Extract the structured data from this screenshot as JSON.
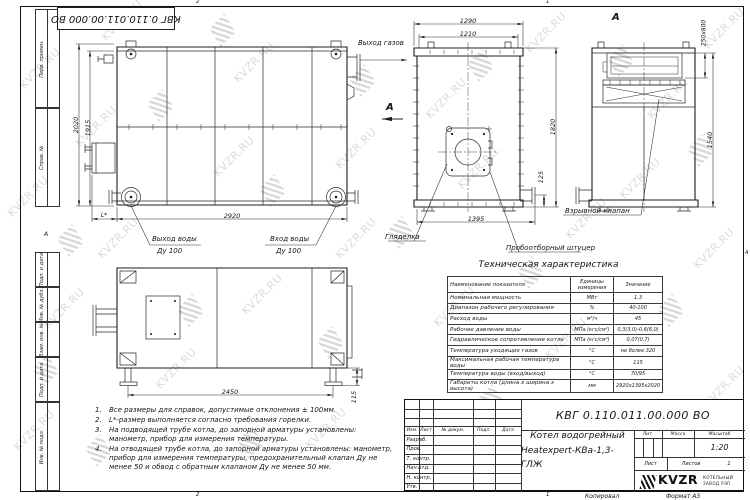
{
  "watermark": {
    "text": "KVZR.RU",
    "color": "#9aa2a9",
    "items": [
      {
        "x": 14,
        "y": 62,
        "t": "text"
      },
      {
        "x": 2,
        "y": 190,
        "t": "text"
      },
      {
        "x": 38,
        "y": 302,
        "t": "text"
      },
      {
        "x": 8,
        "y": 424,
        "t": "text"
      },
      {
        "x": 70,
        "y": 120,
        "t": "text"
      },
      {
        "x": 96,
        "y": 14,
        "t": "text"
      },
      {
        "x": 228,
        "y": 56,
        "t": "text"
      },
      {
        "x": 330,
        "y": 142,
        "t": "text"
      },
      {
        "x": 236,
        "y": 288,
        "t": "text"
      },
      {
        "x": 150,
        "y": 362,
        "t": "text"
      },
      {
        "x": 300,
        "y": 422,
        "t": "text"
      },
      {
        "x": 420,
        "y": 92,
        "t": "text"
      },
      {
        "x": 520,
        "y": 26,
        "t": "text"
      },
      {
        "x": 452,
        "y": 162,
        "t": "text"
      },
      {
        "x": 560,
        "y": 212,
        "t": "text"
      },
      {
        "x": 642,
        "y": 92,
        "t": "text"
      },
      {
        "x": 698,
        "y": 22,
        "t": "text"
      },
      {
        "x": 614,
        "y": 172,
        "t": "text"
      },
      {
        "x": 688,
        "y": 242,
        "t": "text"
      },
      {
        "x": 540,
        "y": 332,
        "t": "text"
      },
      {
        "x": 428,
        "y": 300,
        "t": "text"
      },
      {
        "x": 618,
        "y": 420,
        "t": "text"
      },
      {
        "x": 698,
        "y": 380,
        "t": "text"
      },
      {
        "x": 330,
        "y": 232,
        "t": "text"
      },
      {
        "x": 92,
        "y": 232,
        "t": "text"
      },
      {
        "x": 208,
        "y": 150,
        "t": "text"
      },
      {
        "x": 150,
        "y": 95,
        "t": "logo"
      },
      {
        "x": 60,
        "y": 230,
        "t": "logo"
      },
      {
        "x": 212,
        "y": 20,
        "t": "logo"
      },
      {
        "x": 352,
        "y": 70,
        "t": "logo"
      },
      {
        "x": 470,
        "y": 55,
        "t": "logo"
      },
      {
        "x": 610,
        "y": 50,
        "t": "logo"
      },
      {
        "x": 690,
        "y": 140,
        "t": "logo"
      },
      {
        "x": 262,
        "y": 180,
        "t": "logo"
      },
      {
        "x": 390,
        "y": 222,
        "t": "logo"
      },
      {
        "x": 180,
        "y": 300,
        "t": "logo"
      },
      {
        "x": 320,
        "y": 332,
        "t": "logo"
      },
      {
        "x": 35,
        "y": 360,
        "t": "logo"
      },
      {
        "x": 480,
        "y": 390,
        "t": "logo"
      },
      {
        "x": 560,
        "y": 432,
        "t": "logo"
      },
      {
        "x": 660,
        "y": 300,
        "t": "logo"
      },
      {
        "x": 703,
        "y": 450,
        "t": "logo"
      },
      {
        "x": 240,
        "y": 432,
        "t": "logo"
      },
      {
        "x": 520,
        "y": 262,
        "t": "logo"
      },
      {
        "x": 430,
        "y": 440,
        "t": "logo"
      },
      {
        "x": 88,
        "y": 440,
        "t": "logo"
      }
    ]
  },
  "frame": {
    "stamp_rotated": "КВГ 0.110.011.00.000 ВО",
    "strip": [
      "Перв. примен.",
      "Справ. №",
      "Подп. и дата",
      "Инв. № дубл.",
      "Взам. инв. №",
      "Подп. и дата",
      "Инв. № подл."
    ],
    "zone_letter_left": "А",
    "zone_letter_right": "А",
    "zone_top_1": "2",
    "zone_top_2": "1",
    "zone_bottom_1": "2",
    "zone_bottom_2": "1",
    "copied": "Копировал",
    "format": "Формат А3"
  },
  "views": {
    "side": {
      "dim_height_outer": "2020",
      "dim_height_inner": "1915",
      "dim_length": "2920",
      "dim_l": "L*",
      "label_gas_out": "Выход газов",
      "label_water_out": "Выход воды",
      "label_water_out_dn": "Ду 100",
      "label_water_in": "Вход воды",
      "label_water_in_dn": "Ду 100",
      "section_mark": "А"
    },
    "front": {
      "dim_width_outer": "1290",
      "dim_width_inner": "1210",
      "dim_height": "1820",
      "dim_pipe": "125",
      "dim_width_base": "1395",
      "label_sight": "Гляделка",
      "label_sampling": "Пробоотборный штуцер"
    },
    "section": {
      "title": "А",
      "dim_duct": "250x800",
      "dim_height": "1540",
      "label_valve": "Взрывной клапан"
    },
    "plan": {
      "dim_length": "2450",
      "dim_foot": "115"
    }
  },
  "notes": [
    {
      "num": "1.",
      "text": "Все размеры для справок, допустимые отклонения ± 100мм."
    },
    {
      "num": "2.",
      "text": "L*-размер выполняется согласно требования горелки."
    },
    {
      "num": "3.",
      "text": "На подводящей трубе котла, до запорной арматуры установлены: манометр, прибор для измерения температуры."
    },
    {
      "num": "4.",
      "text": "На отводящей трубе котла, до запорной арматуры установлены: манометр, прибор для измерения температуры, предохранительный клапан Ду не менее 50 и обвод с обратным клапаном Ду не менее 50 мм."
    }
  ],
  "tech_table": {
    "title": "Техническая характеристика",
    "col_name": "Наименование показателя",
    "col_units": "Единицы измерения",
    "col_value": "Значение",
    "rows": [
      [
        "Номинальная мощность",
        "МВт",
        "1,3"
      ],
      [
        "Диапазон рабочего регулирования",
        "%",
        "40-100"
      ],
      [
        "Расход воды",
        "м³/ч",
        "45"
      ],
      [
        "Рабочее давление воды",
        "МПа (кгс/см²)",
        "0,3(3,0)-0,6(6,0)"
      ],
      [
        "Гидравлическое сопротивление котла",
        "МПа (кгс/см²)",
        "0,07(0,7)"
      ],
      [
        "Температура уходящих газов",
        "°С",
        "не более 320"
      ],
      [
        "Максимальная рабочая температура воды",
        "°С",
        "115"
      ],
      [
        "Температура воды (вход/выход)",
        "°С",
        "70/95"
      ],
      [
        "Габариты котла (длина х ширина х высота)",
        "мм",
        "2920х1395х2020"
      ]
    ]
  },
  "title_block": {
    "doc_number": "КВГ 0.110.011.00.000 ВО",
    "name_line1": "Котел водогрейный",
    "name_line2": "Heatexpert-КВа-1,3-ГЛЖ",
    "cols": [
      "Изм.",
      "Лист",
      "№ докум.",
      "Подп.",
      "Дата"
    ],
    "sig_rows": [
      "Разраб.",
      "Пров.",
      "Т. контр.",
      "Нач.отд.",
      "Н. контр.",
      "Утв."
    ],
    "lit_label": "Лит.",
    "mass_label": "Масса",
    "scale_label": "Масштаб",
    "scale_value": "1:20",
    "sheet_label": "Лист",
    "sheets_label": "Листов",
    "sheets_value": "1",
    "logo_text": "KVZR",
    "logo_sub1": "КОТЕЛЬНЫЙ",
    "logo_sub2": "ЗАВОД РЭП"
  }
}
